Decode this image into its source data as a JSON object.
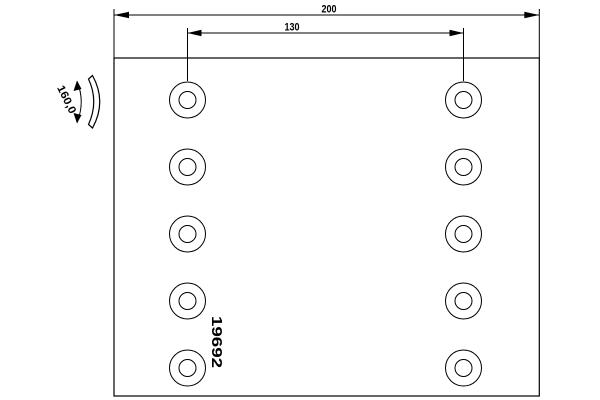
{
  "drawing": {
    "part_number": "19692",
    "dimensions": {
      "overall_length": "200",
      "hole_spacing": "130",
      "radius": "160,0"
    },
    "holes": {
      "rows": 5,
      "columns": 2,
      "total": 10
    },
    "colors": {
      "line": "#000000",
      "background": "#ffffff"
    }
  }
}
